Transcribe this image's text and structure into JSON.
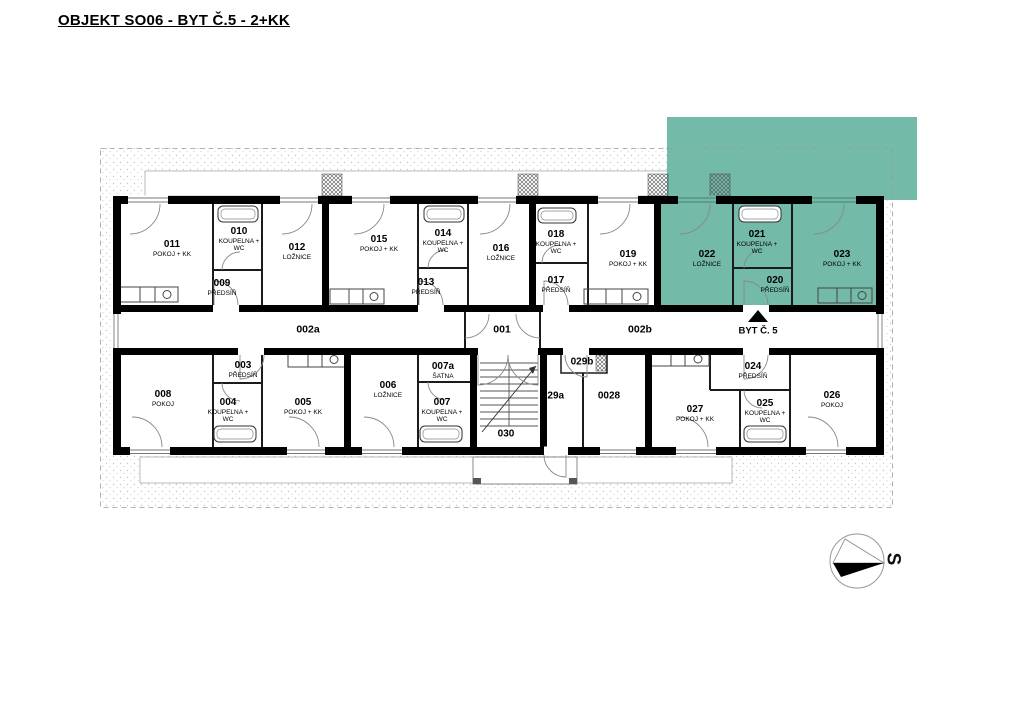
{
  "title": "OBJEKT SO06 - BYT Č.5 - 2+KK",
  "colors": {
    "highlight": "#73BAA8",
    "wall": "#000000"
  },
  "compass": {
    "north_label": "S"
  },
  "corridor": {
    "hall_left": "002a",
    "entrance_hall": "001",
    "hall_right": "002b",
    "apartment_pointer": "BYT Č. 5"
  },
  "rooms": {
    "r011": {
      "number": "011",
      "type": "POKOJ + KK"
    },
    "r010": {
      "number": "010",
      "type": "KOUPELNA + WC"
    },
    "r009": {
      "number": "009",
      "type": "PŘEDSÍŇ"
    },
    "r012": {
      "number": "012",
      "type": "LOŽNICE"
    },
    "r015": {
      "number": "015",
      "type": "POKOJ + KK"
    },
    "r014": {
      "number": "014",
      "type": "KOUPELNA + WC"
    },
    "r013": {
      "number": "013",
      "type": "PŘEDSÍŇ"
    },
    "r016": {
      "number": "016",
      "type": "LOŽNICE"
    },
    "r018": {
      "number": "018",
      "type": "KOUPELNA + WC"
    },
    "r017": {
      "number": "017",
      "type": "PŘEDSÍŇ"
    },
    "r019": {
      "number": "019",
      "type": "POKOJ + KK"
    },
    "r022": {
      "number": "022",
      "type": "LOŽNICE"
    },
    "r021": {
      "number": "021",
      "type": "KOUPELNA + WC"
    },
    "r020": {
      "number": "020",
      "type": "PŘEDSÍŇ"
    },
    "r023": {
      "number": "023",
      "type": "POKOJ + KK"
    },
    "r008": {
      "number": "008",
      "type": "POKOJ"
    },
    "r003": {
      "number": "003",
      "type": "PŘEDSÍŇ"
    },
    "r004": {
      "number": "004",
      "type": "KOUPELNA + WC"
    },
    "r005": {
      "number": "005",
      "type": "POKOJ + KK"
    },
    "r006": {
      "number": "006",
      "type": "LOŽNICE"
    },
    "r007a": {
      "number": "007a",
      "type": "ŠATNA"
    },
    "r007": {
      "number": "007",
      "type": "KOUPELNA + WC"
    },
    "r030": {
      "number": "030"
    },
    "r029a": {
      "number": "029a"
    },
    "r029b": {
      "number": "029b"
    },
    "r0028": {
      "number": "0028"
    },
    "r027": {
      "number": "027",
      "type": "POKOJ + KK"
    },
    "r024": {
      "number": "024",
      "type": "PŘEDSÍŇ"
    },
    "r025": {
      "number": "025",
      "type": "KOUPELNA + WC"
    },
    "r026": {
      "number": "026",
      "type": "POKOJ"
    }
  }
}
